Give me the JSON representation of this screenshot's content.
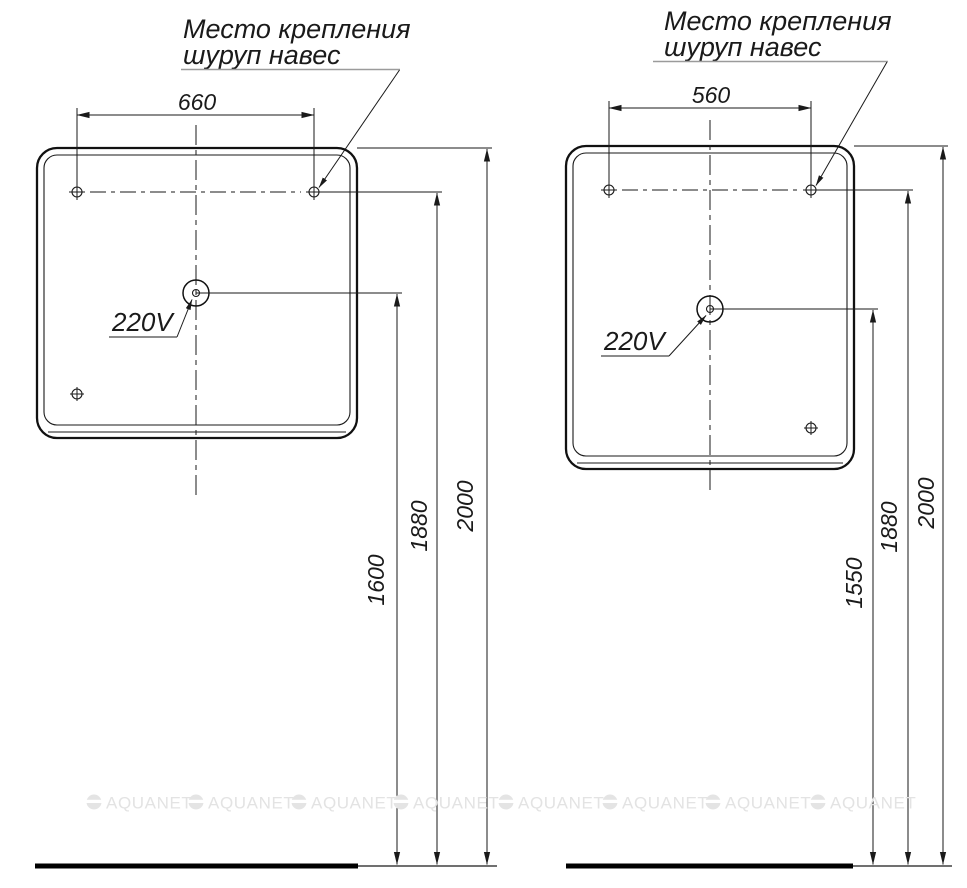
{
  "sheet": {
    "watermark_text": "AQUANET",
    "line_color": "#1a1a1a",
    "watermark_color": "#e3e3e3"
  },
  "left_diagram": {
    "mount_note_line1": "Место крепления",
    "mount_note_line2": "шуруп навес",
    "hole_spacing": "660",
    "socket_label": "220V",
    "dim_socket_to_floor": "1600",
    "dim_holes_to_floor": "1880",
    "dim_top_to_floor": "2000"
  },
  "right_diagram": {
    "mount_note_line1": "Место крепления",
    "mount_note_line2": "шуруп навес",
    "hole_spacing": "560",
    "socket_label": "220V",
    "dim_socket_to_floor": "1550",
    "dim_holes_to_floor": "1880",
    "dim_top_to_floor": "2000"
  }
}
